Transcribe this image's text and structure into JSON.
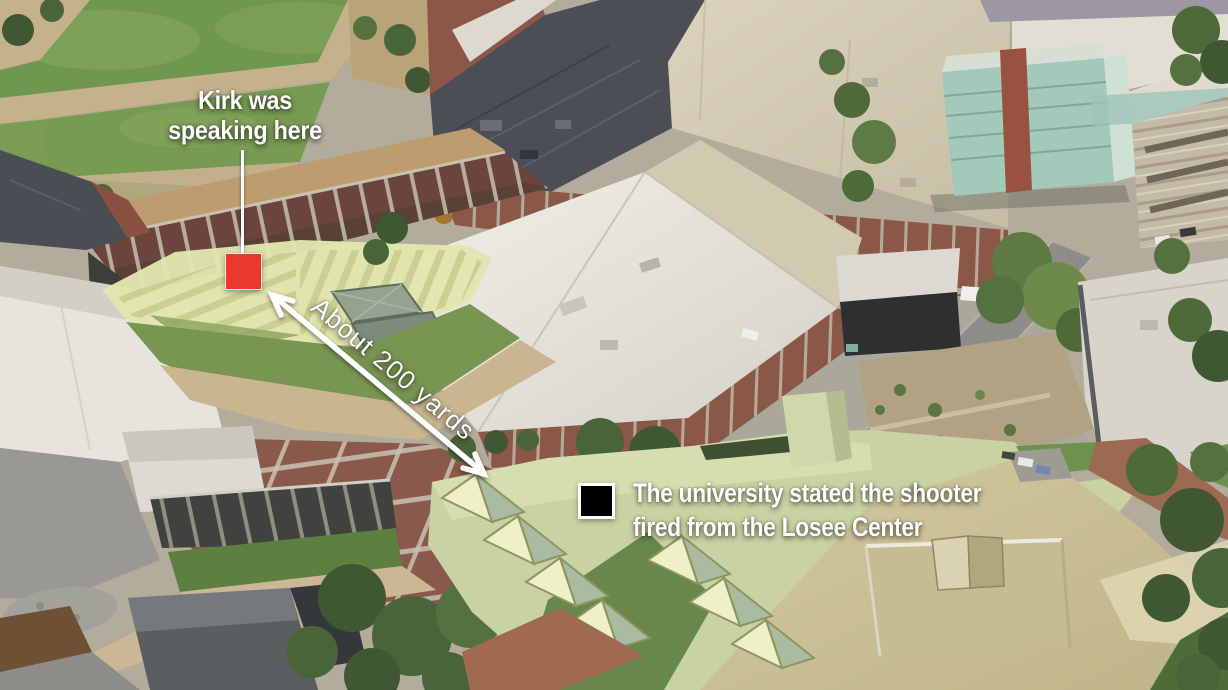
{
  "annotations": {
    "speaker": {
      "line1": "Kirk was",
      "line2": "speaking here",
      "marker_color": "#e8392c"
    },
    "distance": {
      "label": "About 200 yards"
    },
    "shooter": {
      "line1": "The university stated the shooter",
      "line2": "fired from the Losee Center",
      "marker_color": "#000000",
      "marker_border": "#ffffff"
    },
    "text_color": "#ffffff",
    "arrow_color": "#ffffff"
  },
  "scene": {
    "courtyard_highlight_color": "#e2e6ae",
    "losee_highlight_color": "#c9d2a2",
    "grass_color": "#6f9750",
    "plaza_color": "#8a594b",
    "roof_slate_color": "#4b4f55",
    "roof_cream_color": "#d5ccb4",
    "roof_tan_color": "#cdc39a",
    "teal_building_color": "#a3c9ba"
  }
}
